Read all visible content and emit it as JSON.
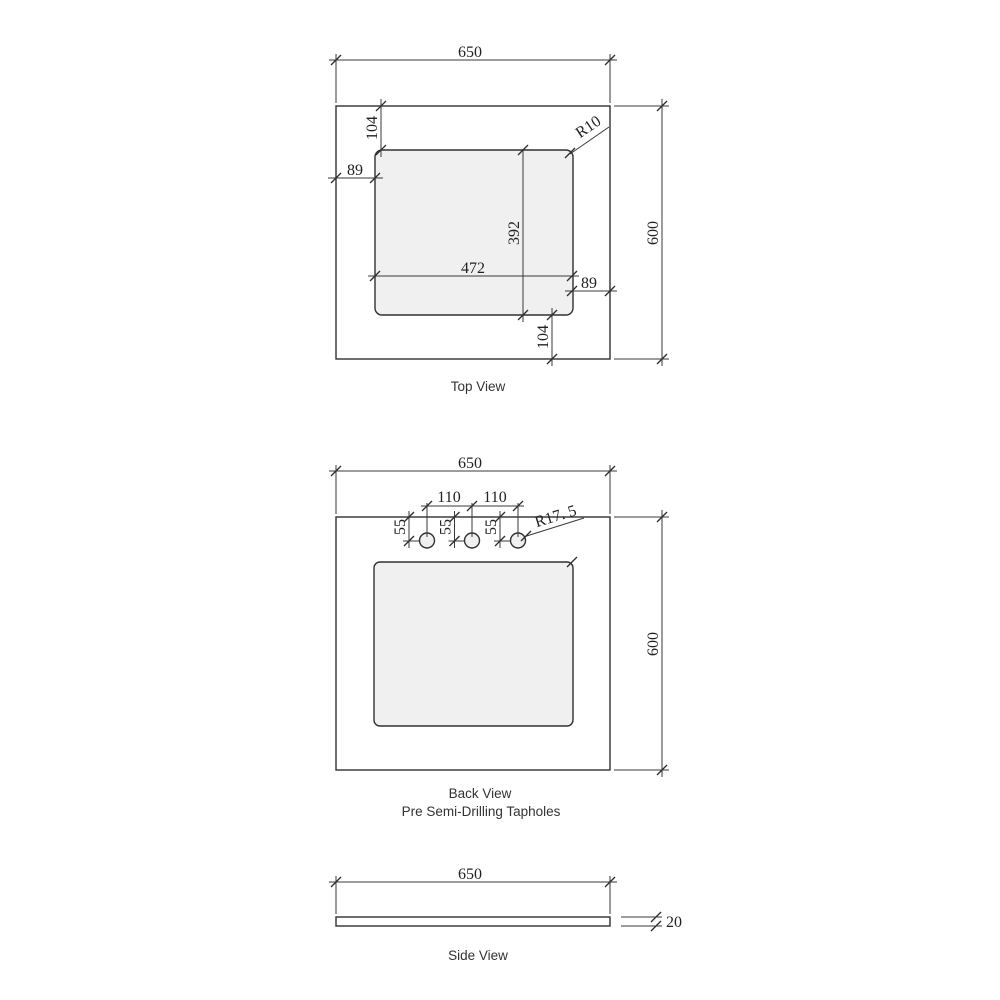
{
  "page": {
    "background_color": "#ffffff",
    "line_color": "#303030",
    "cutout_fill_color": "#f0f0f0"
  },
  "top_view": {
    "label": "Top View",
    "dims": {
      "overall_width": "650",
      "overall_depth": "600",
      "inset_top": "104",
      "inset_left": "89",
      "cutout_depth": "392",
      "cutout_width": "472",
      "inset_right": "89",
      "inset_bottom": "104",
      "corner_radius": "R10"
    }
  },
  "back_view": {
    "label": "Back View",
    "sublabel": "Pre Semi-Drilling Tapholes",
    "dims": {
      "overall_width": "650",
      "overall_height": "600",
      "taphole_spacing_left": "110",
      "taphole_spacing_right": "110",
      "taphole_offset_1": "55",
      "taphole_offset_2": "55",
      "taphole_offset_3": "55",
      "taphole_radius": "R17. 5"
    }
  },
  "side_view": {
    "label": "Side View",
    "dims": {
      "overall_width": "650",
      "thickness": "20"
    }
  }
}
